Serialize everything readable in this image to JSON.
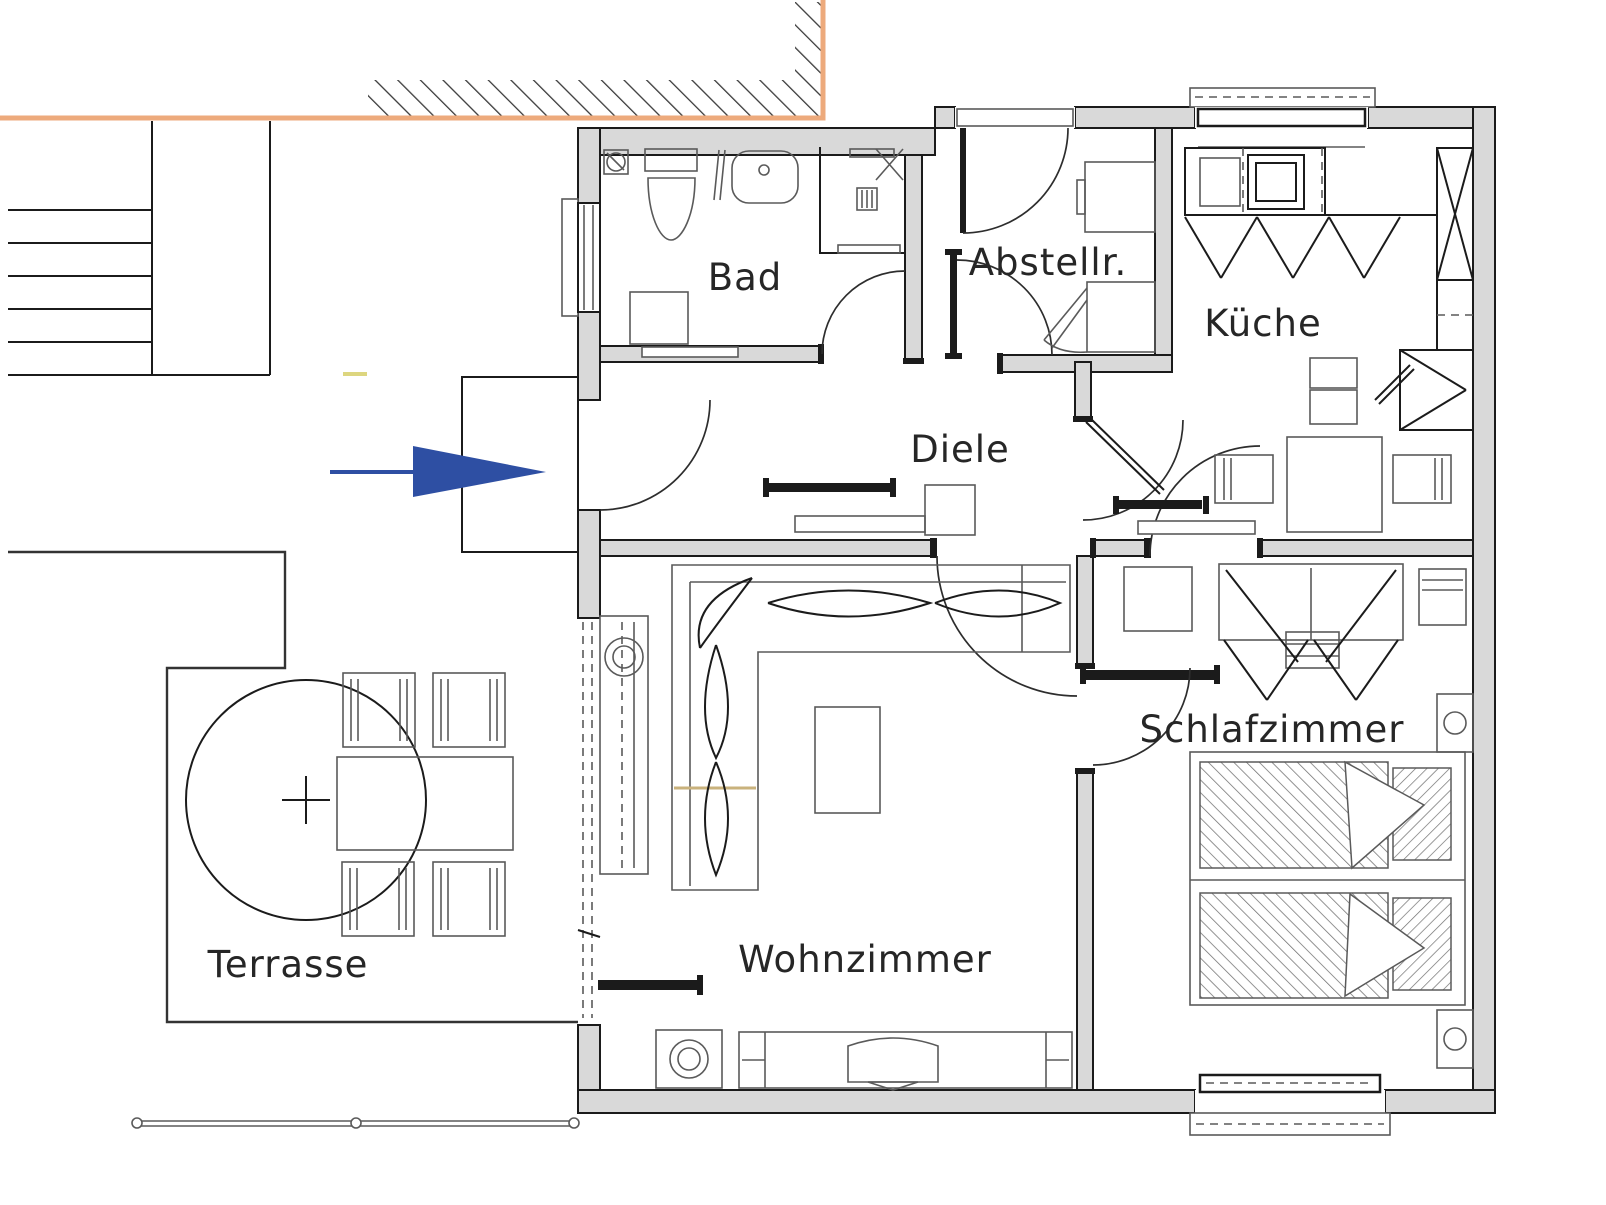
{
  "title": "Grundriss Erdgeschoss Wohnung",
  "colors": {
    "wall_fill": "#d9d9d9",
    "line": "#1b1b1b",
    "thin": "#5a5a5a",
    "site_orange": "#edaa7c",
    "arrow_blue": "#2e4fa3",
    "mark_yellow": "#ddd67f",
    "accent_tan": "#c9b27c"
  },
  "rooms": [
    {
      "id": "bad",
      "label": "Bad"
    },
    {
      "id": "abstellraum",
      "label": "Abstellr."
    },
    {
      "id": "kueche",
      "label": "Küche"
    },
    {
      "id": "diele",
      "label": "Diele"
    },
    {
      "id": "wohnzimmer",
      "label": "Wohnzimmer"
    },
    {
      "id": "schlafzimmer",
      "label": "Schlafzimmer"
    },
    {
      "id": "terrasse",
      "label": "Terrasse"
    }
  ],
  "entrance_arrow": {
    "direction": "right",
    "color": "#2e4fa3"
  },
  "fixtures": [
    "toilet",
    "sink",
    "shower",
    "washer",
    "floor-drain",
    "appliance",
    "kitchen-counter",
    "stove",
    "fridge",
    "kitchen-table",
    "chair",
    "sideboard",
    "sliding-door",
    "radiator",
    "corner-sofa",
    "coffee-table",
    "tv-lowboard",
    "subwoofer",
    "wardrobe",
    "dresser",
    "bed",
    "pillow",
    "nightstand",
    "terrace-table",
    "parasol",
    "stairs",
    "fence"
  ]
}
